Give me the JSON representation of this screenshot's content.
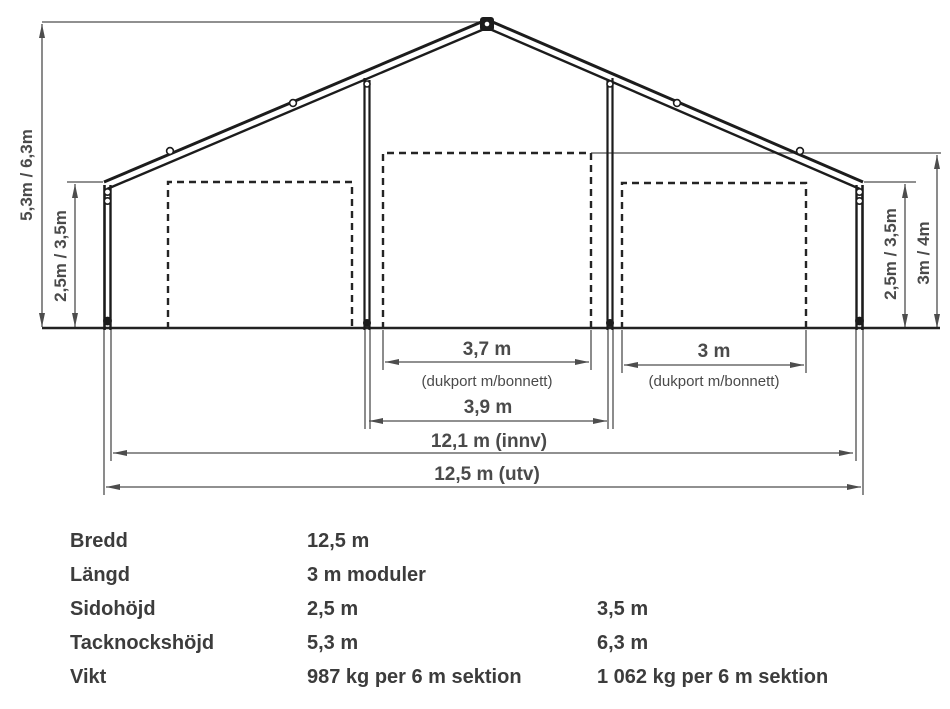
{
  "diagram": {
    "ridge_height": "5,3m / 6,3m",
    "side_height_left": "2,5m / 3,5m",
    "side_height_right": "2,5m / 3,5m",
    "door_height_right": "3m / 4m",
    "center_door_width": "3,7 m",
    "center_door_note": "(dukport m/bonnett)",
    "right_door_width": "3 m",
    "right_door_note": "(dukport m/bonnett)",
    "bay_width": "3,9 m",
    "inner_width": "12,1 m (innv)",
    "outer_width": "12,5 m (utv)"
  },
  "specs": {
    "rows": [
      {
        "label": "Bredd",
        "value1": "12,5 m",
        "value2": ""
      },
      {
        "label": "Längd",
        "value1": "3 m moduler",
        "value2": ""
      },
      {
        "label": "Sidohöjd",
        "value1": "2,5 m",
        "value2": "3,5 m"
      },
      {
        "label": "Tacknockshöjd",
        "value1": "5,3 m",
        "value2": "6,3 m"
      },
      {
        "label": "Vikt",
        "value1": "987 kg per 6 m sektion",
        "value2": "1 062 kg per 6 m sektion"
      }
    ]
  },
  "colors": {
    "structure": "#1c1c1c",
    "dimension": "#4d4d4d",
    "text": "#3c3c3c",
    "background": "#ffffff"
  }
}
